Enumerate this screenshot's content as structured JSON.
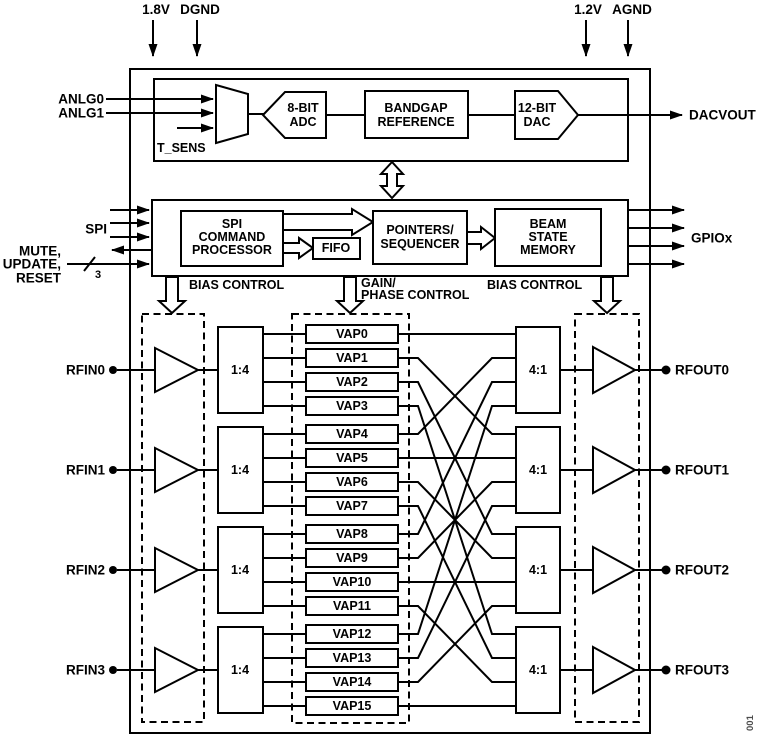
{
  "figure_tag": "001",
  "power": {
    "left": [
      {
        "label": "1.8V"
      },
      {
        "label": "DGND"
      }
    ],
    "right": [
      {
        "label": "1.2V"
      },
      {
        "label": "AGND"
      }
    ]
  },
  "analog": {
    "inputs": [
      "ANLG0",
      "ANLG1"
    ],
    "temp_sensor": "T_SENS",
    "adc": [
      "8-BIT",
      "ADC"
    ],
    "bandgap": [
      "BANDGAP",
      "REFERENCE"
    ],
    "dac": [
      "12-BIT",
      "DAC"
    ],
    "output": "DACVOUT"
  },
  "digital": {
    "spi_label": "SPI",
    "mute_lines": [
      "MUTE,",
      "UPDATE,",
      "RESET"
    ],
    "bus_width": "3",
    "spi_processor": [
      "SPI",
      "COMMAND",
      "PROCESSOR"
    ],
    "fifo": "FIFO",
    "pointers": [
      "POINTERS/",
      "SEQUENCER"
    ],
    "beam_memory": [
      "BEAM",
      "STATE",
      "MEMORY"
    ],
    "gpio_label": "GPIOx"
  },
  "control": {
    "bias_left": "BIAS CONTROL",
    "gain_phase": [
      "GAIN/",
      "PHASE CONTROL"
    ],
    "bias_right": "BIAS CONTROL"
  },
  "rf": {
    "inputs": [
      "RFIN0",
      "RFIN1",
      "RFIN2",
      "RFIN3"
    ],
    "outputs": [
      "RFOUT0",
      "RFOUT1",
      "RFOUT2",
      "RFOUT3"
    ],
    "splitter": "1:4",
    "combiner": "4:1",
    "vaps": [
      "VAP0",
      "VAP1",
      "VAP2",
      "VAP3",
      "VAP4",
      "VAP5",
      "VAP6",
      "VAP7",
      "VAP8",
      "VAP9",
      "VAP10",
      "VAP11",
      "VAP12",
      "VAP13",
      "VAP14",
      "VAP15"
    ]
  }
}
